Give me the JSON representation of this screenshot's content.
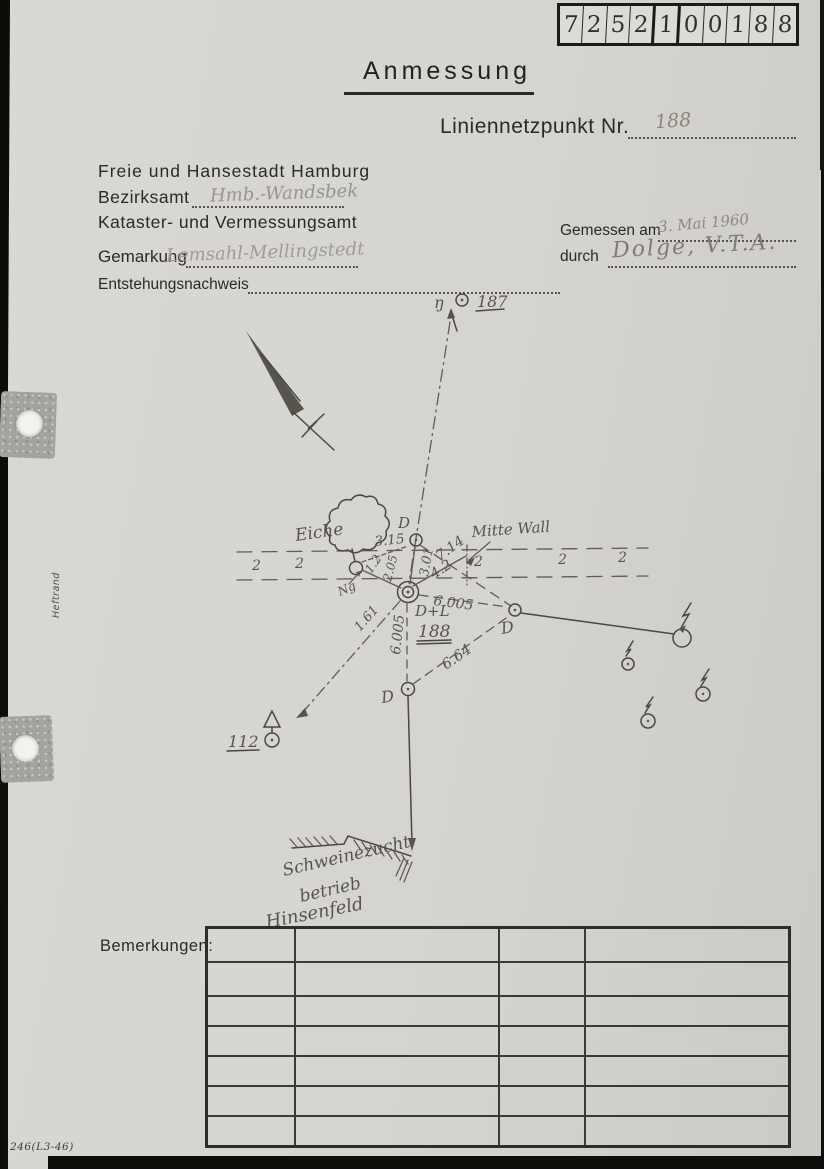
{
  "page": {
    "corner_code": "246(L3-46)",
    "margin_label": "Heftrand"
  },
  "index_box": {
    "digits_a": [
      "7",
      "2",
      "5",
      "2"
    ],
    "digits_b": [
      "1"
    ],
    "digits_c": [
      "0",
      "0",
      "1",
      "8",
      "8"
    ],
    "ghost_text": "100"
  },
  "form": {
    "title": "Anmessung",
    "point_label": "Liniennetzpunkt Nr.",
    "point_number": "188",
    "city": "Freie und Hansestadt Hamburg",
    "district_label": "Bezirksamt",
    "district_value": "Hmb.-Wandsbek",
    "office": "Kataster- und Vermessungsamt",
    "gemarkung_label": "Gemarkung",
    "gemarkung_value": "Lemsahl-Mellingstedt",
    "origin_label": "Entstehungsnachweis",
    "measured_on_label": "Gemessen am",
    "measured_on_value": "3. Mai 1960",
    "measured_by_label": "durch",
    "measured_by_value": "Dolge, V.T.A."
  },
  "sketch": {
    "point_187": {
      "prefix": "ŋ",
      "number": "187"
    },
    "tree_label": "Eiche",
    "wall_label": "Mitte Wall",
    "wall_symbol": "2",
    "ng_label": "Ng",
    "center": {
      "type": "D+L",
      "number": "188"
    },
    "d_label": "D",
    "point_112": "112",
    "farm_lines": [
      "Schweinezucht-",
      "betrieb",
      "Hinsenfeld"
    ],
    "measurements": {
      "tree_to_d": "3.15",
      "d_to_d2": "7.14",
      "center_to_d": "3.01",
      "center_to_wall": "4.2",
      "center_short_a": "1.2",
      "center_short_b": "2.05",
      "center_to_d2": "6.005",
      "center_to_d3": "6.005",
      "d3_to_d2": "6.64",
      "center_sw": "1.61"
    }
  },
  "remarks": {
    "label": "Bemerkungen:"
  }
}
